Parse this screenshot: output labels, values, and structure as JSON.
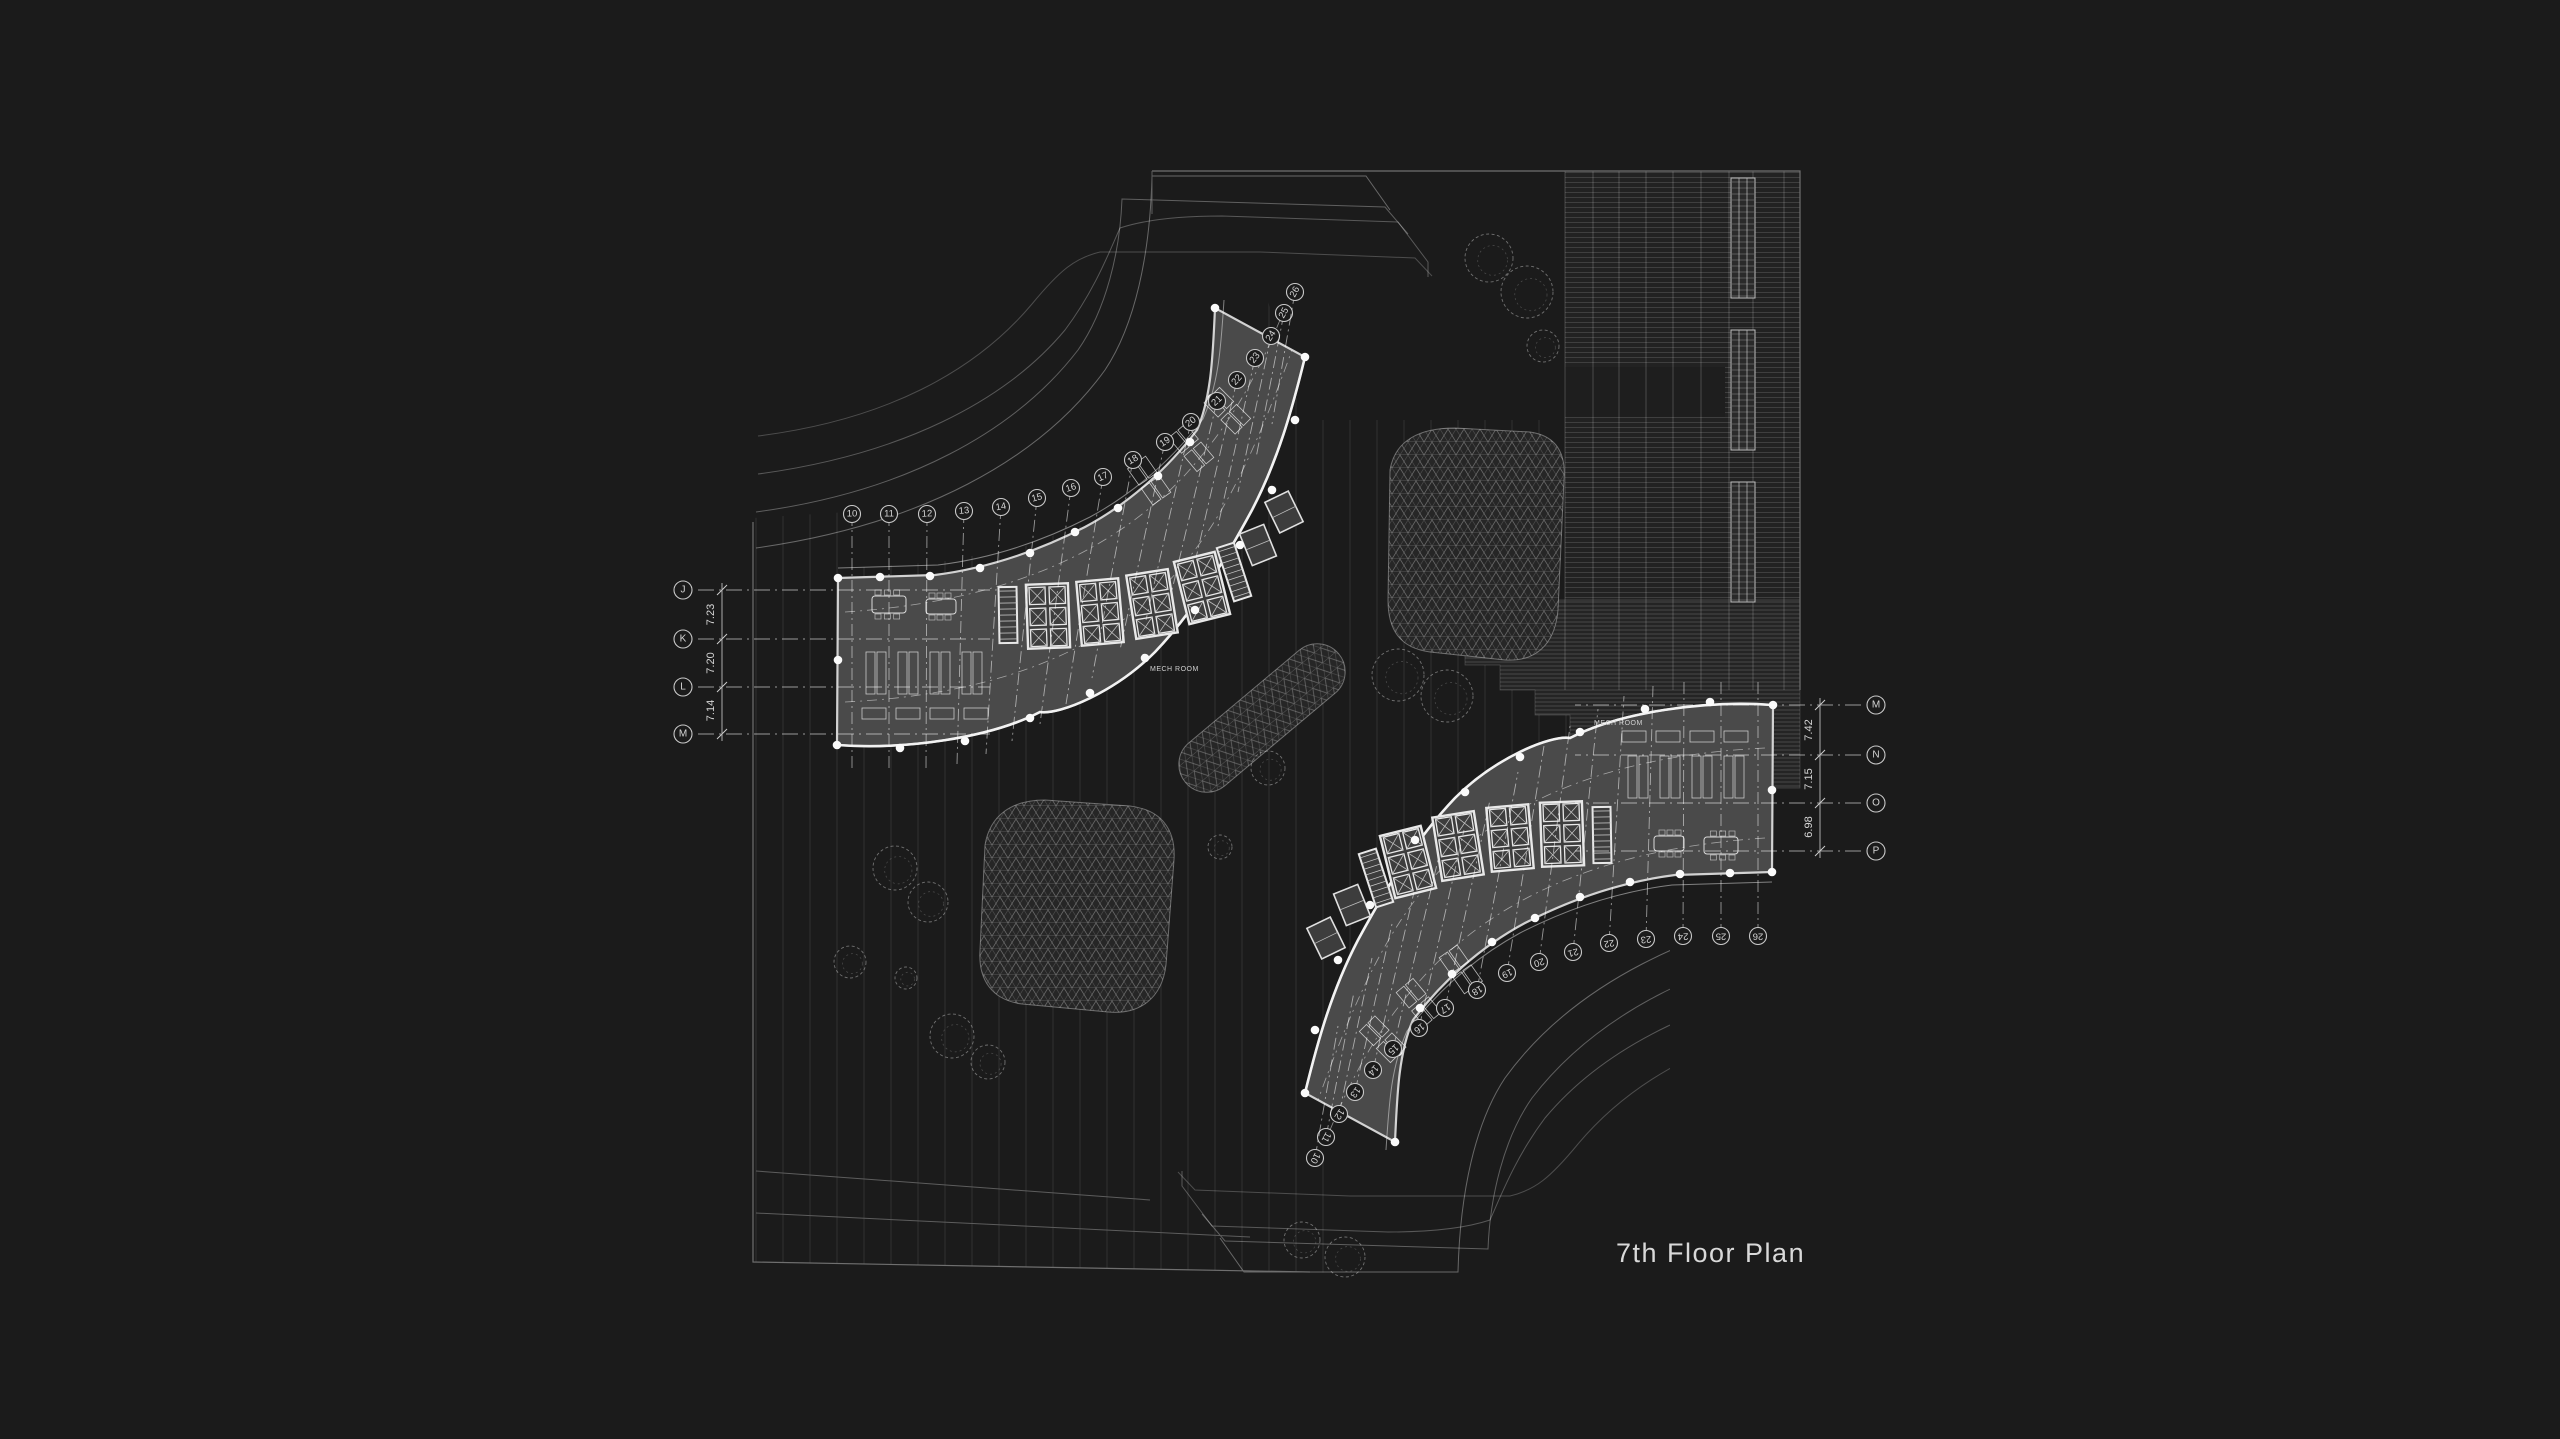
{
  "title": "7th Floor Plan",
  "labels": {
    "mech_room": "MECH ROOM"
  },
  "grids": {
    "left": {
      "letters": [
        "J",
        "K",
        "L",
        "M"
      ],
      "dims": [
        "7.23",
        "7.20",
        "7.14"
      ]
    },
    "right": {
      "letters": [
        "M",
        "N",
        "O",
        "P"
      ],
      "dims": [
        "7.42",
        "7.15",
        "6.98"
      ]
    },
    "upper_numbers": [
      "10",
      "11",
      "12",
      "13",
      "14",
      "15",
      "16",
      "17",
      "18",
      "19",
      "20",
      "21",
      "22",
      "23",
      "24",
      "25",
      "26"
    ],
    "lower_numbers": [
      "10",
      "11",
      "12",
      "13",
      "14",
      "15",
      "16",
      "17",
      "18",
      "19",
      "20",
      "21",
      "22",
      "23",
      "24",
      "25",
      "26"
    ]
  },
  "colors": {
    "background": "#1b1b1b",
    "site_line": "#7a7a7a",
    "faint_line": "#5a5a5a",
    "wing_fill": "#4a4a4a",
    "wall_bright": "#e9e9e9",
    "bubble_stroke": "#c8c8c8",
    "text_light": "#d6d6d6",
    "dot_white": "#fafafa"
  }
}
